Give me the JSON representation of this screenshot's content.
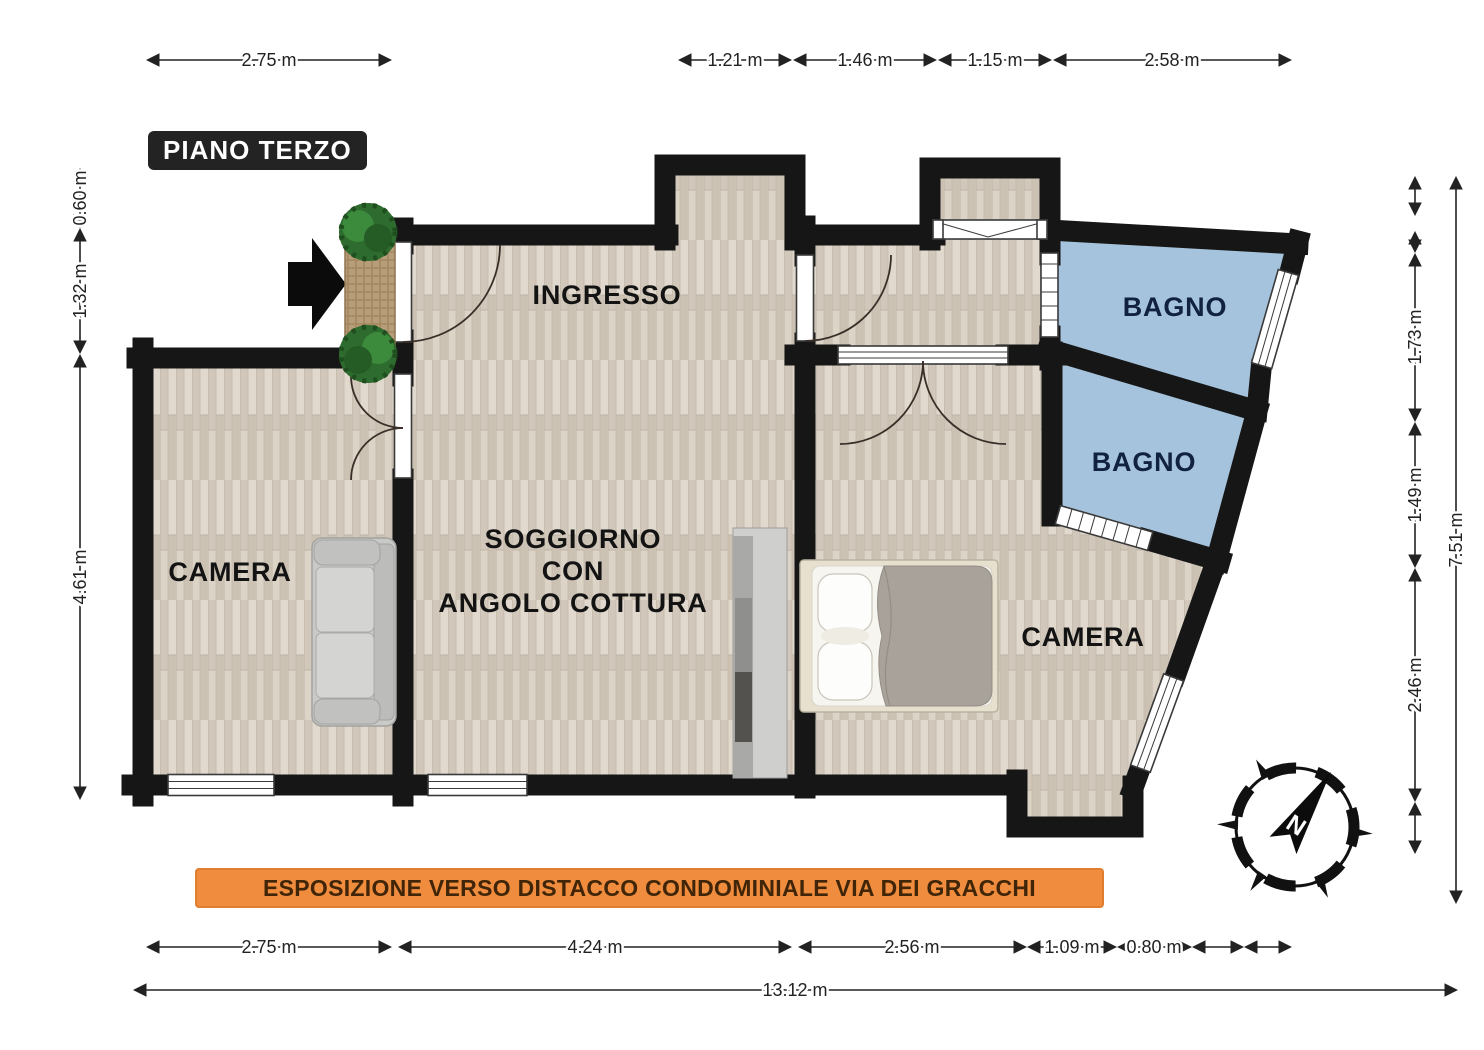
{
  "floor_label": "PIANO TERZO",
  "banner_text": "ESPOSIZIONE VERSO DISTACCO CONDOMINIALE VIA DEI GRACCHI",
  "rooms": {
    "ingresso": "INGRESSO",
    "camera_left": "CAMERA",
    "camera_right": "CAMERA",
    "bagno_upper": "BAGNO",
    "bagno_lower": "BAGNO",
    "soggiorno_line1": "SOGGIORNO",
    "soggiorno_line2": "CON",
    "soggiorno_line3": "ANGOLO COTTURA"
  },
  "dimensions": {
    "top": [
      "2.75 m",
      "1.21 m",
      "1.46 m",
      "1.15 m",
      "2.58 m"
    ],
    "left": [
      "0.60 m",
      "1.32 m",
      "4.61 m"
    ],
    "right": [
      "1.73 m",
      "1.49 m",
      "2.46 m"
    ],
    "right_total": "7.51 m",
    "bottom": [
      "2.75 m",
      "4.24 m",
      "2.56 m",
      "1.09 m",
      "0.80 m"
    ],
    "bottom_total": "13.12 m"
  },
  "compass": {
    "north": "N"
  },
  "colors": {
    "wall": "#161616",
    "wood_floor": "#d8cfc3",
    "bagno_floor": "#a5c3dc",
    "banner_bg": "#ef8c3d",
    "banner_text": "#402508",
    "title_bg": "#232323",
    "title_text": "#ffffff"
  }
}
